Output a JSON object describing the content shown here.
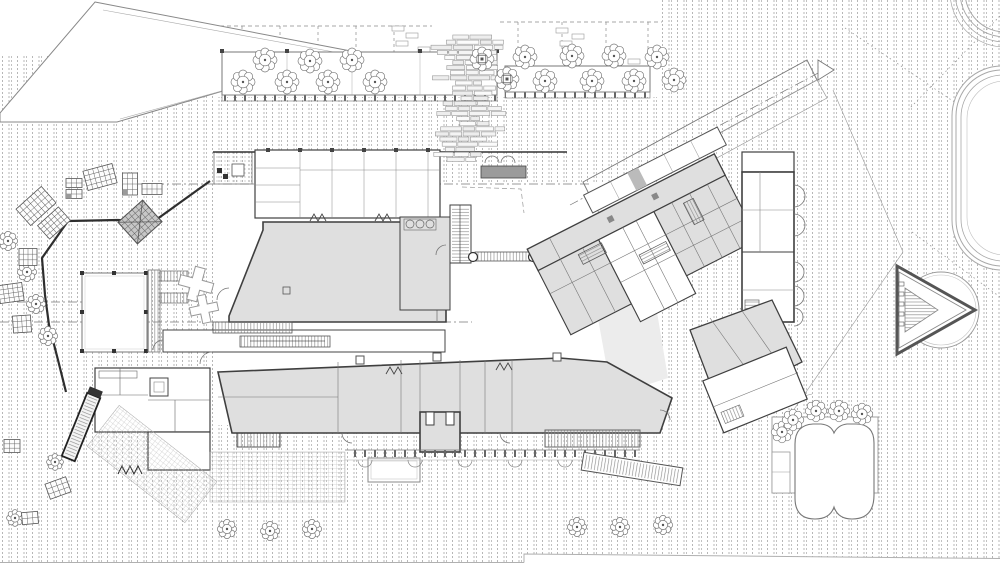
{
  "canvas": {
    "width": 1000,
    "height": 572,
    "background": "#ffffff"
  },
  "palette": {
    "wall": "#3f3f3f",
    "line": "#6e6e6e",
    "light": "#9a9a9a",
    "faint": "#c3c3c3",
    "room_fill": "#dfdfdf",
    "room_fill_dark": "#cfcfcf",
    "shadow_fill": "#ececec",
    "stripe": "#b7b7b7",
    "mat": "#9b9b9b",
    "hatch": "#8c8c8c",
    "post": "#444444"
  },
  "decorations": {
    "trees": [
      {
        "x": 265,
        "y": 60,
        "r": 10
      },
      {
        "x": 310,
        "y": 61,
        "r": 10
      },
      {
        "x": 352,
        "y": 60,
        "r": 10
      },
      {
        "x": 243,
        "y": 82,
        "r": 10
      },
      {
        "x": 287,
        "y": 82,
        "r": 10
      },
      {
        "x": 328,
        "y": 82,
        "r": 10
      },
      {
        "x": 375,
        "y": 82,
        "r": 10
      },
      {
        "x": 482,
        "y": 59,
        "r": 10,
        "grate": true
      },
      {
        "x": 507,
        "y": 79,
        "r": 10,
        "grate": true
      },
      {
        "x": 525,
        "y": 57,
        "r": 10
      },
      {
        "x": 572,
        "y": 56,
        "r": 10
      },
      {
        "x": 614,
        "y": 56,
        "r": 10
      },
      {
        "x": 657,
        "y": 57,
        "r": 10
      },
      {
        "x": 545,
        "y": 81,
        "r": 10
      },
      {
        "x": 592,
        "y": 81,
        "r": 10
      },
      {
        "x": 634,
        "y": 81,
        "r": 10
      },
      {
        "x": 674,
        "y": 80,
        "r": 10
      },
      {
        "x": 227,
        "y": 529,
        "r": 8
      },
      {
        "x": 270,
        "y": 531,
        "r": 8
      },
      {
        "x": 312,
        "y": 529,
        "r": 8
      },
      {
        "x": 577,
        "y": 527,
        "r": 8
      },
      {
        "x": 620,
        "y": 527,
        "r": 8
      },
      {
        "x": 663,
        "y": 525,
        "r": 8
      },
      {
        "x": 8,
        "y": 241,
        "r": 8
      },
      {
        "x": 27,
        "y": 272,
        "r": 8
      },
      {
        "x": 36,
        "y": 304,
        "r": 8
      },
      {
        "x": 48,
        "y": 336,
        "r": 8
      },
      {
        "x": 55,
        "y": 462,
        "r": 7
      },
      {
        "x": 15,
        "y": 518,
        "r": 7
      },
      {
        "x": 782,
        "y": 432,
        "r": 9
      },
      {
        "x": 793,
        "y": 420,
        "r": 9
      },
      {
        "x": 816,
        "y": 411,
        "r": 9
      },
      {
        "x": 839,
        "y": 411,
        "r": 9
      },
      {
        "x": 862,
        "y": 414,
        "r": 9
      }
    ],
    "tables": [
      {
        "x": 100,
        "y": 177,
        "w": 30,
        "h": 20,
        "a": -15
      },
      {
        "x": 74,
        "y": 183,
        "w": 16,
        "h": 9,
        "a": 0
      },
      {
        "x": 74,
        "y": 194,
        "w": 16,
        "h": 9,
        "a": 0,
        "cell": true
      },
      {
        "x": 130,
        "y": 184,
        "w": 15,
        "h": 22,
        "a": 0,
        "cell": true
      },
      {
        "x": 152,
        "y": 189,
        "w": 20,
        "h": 11,
        "a": 0
      },
      {
        "x": 36,
        "y": 206,
        "w": 34,
        "h": 22,
        "a": -42
      },
      {
        "x": 54,
        "y": 223,
        "w": 28,
        "h": 18,
        "a": -42
      },
      {
        "x": 28,
        "y": 257,
        "w": 18,
        "h": 17,
        "a": 0
      },
      {
        "x": 11,
        "y": 293,
        "w": 24,
        "h": 18,
        "a": -8
      },
      {
        "x": 22,
        "y": 324,
        "w": 18,
        "h": 17,
        "a": -4
      },
      {
        "x": 12,
        "y": 446,
        "w": 16,
        "h": 13,
        "a": 0
      },
      {
        "x": 58,
        "y": 488,
        "w": 22,
        "h": 16,
        "a": -20
      },
      {
        "x": 30,
        "y": 518,
        "w": 16,
        "h": 12,
        "a": -5
      },
      {
        "x": 140,
        "y": 222,
        "w": 33,
        "h": 29,
        "a": -42,
        "dark": true
      }
    ],
    "crosses": [
      {
        "x": 196,
        "y": 284,
        "s": 34,
        "a": 15
      },
      {
        "x": 204,
        "y": 309,
        "s": 28,
        "a": -12
      }
    ]
  },
  "mosaic": {
    "cx": 472,
    "top": 35,
    "bottom": 163,
    "row_height": 5.1,
    "seed": 7,
    "min_w": 8,
    "max_w": 22,
    "drift_row": 18,
    "drift": 1.8,
    "stone_colors": [
      "#fbfbfb",
      "#ededed",
      "#f4f4f4"
    ]
  }
}
